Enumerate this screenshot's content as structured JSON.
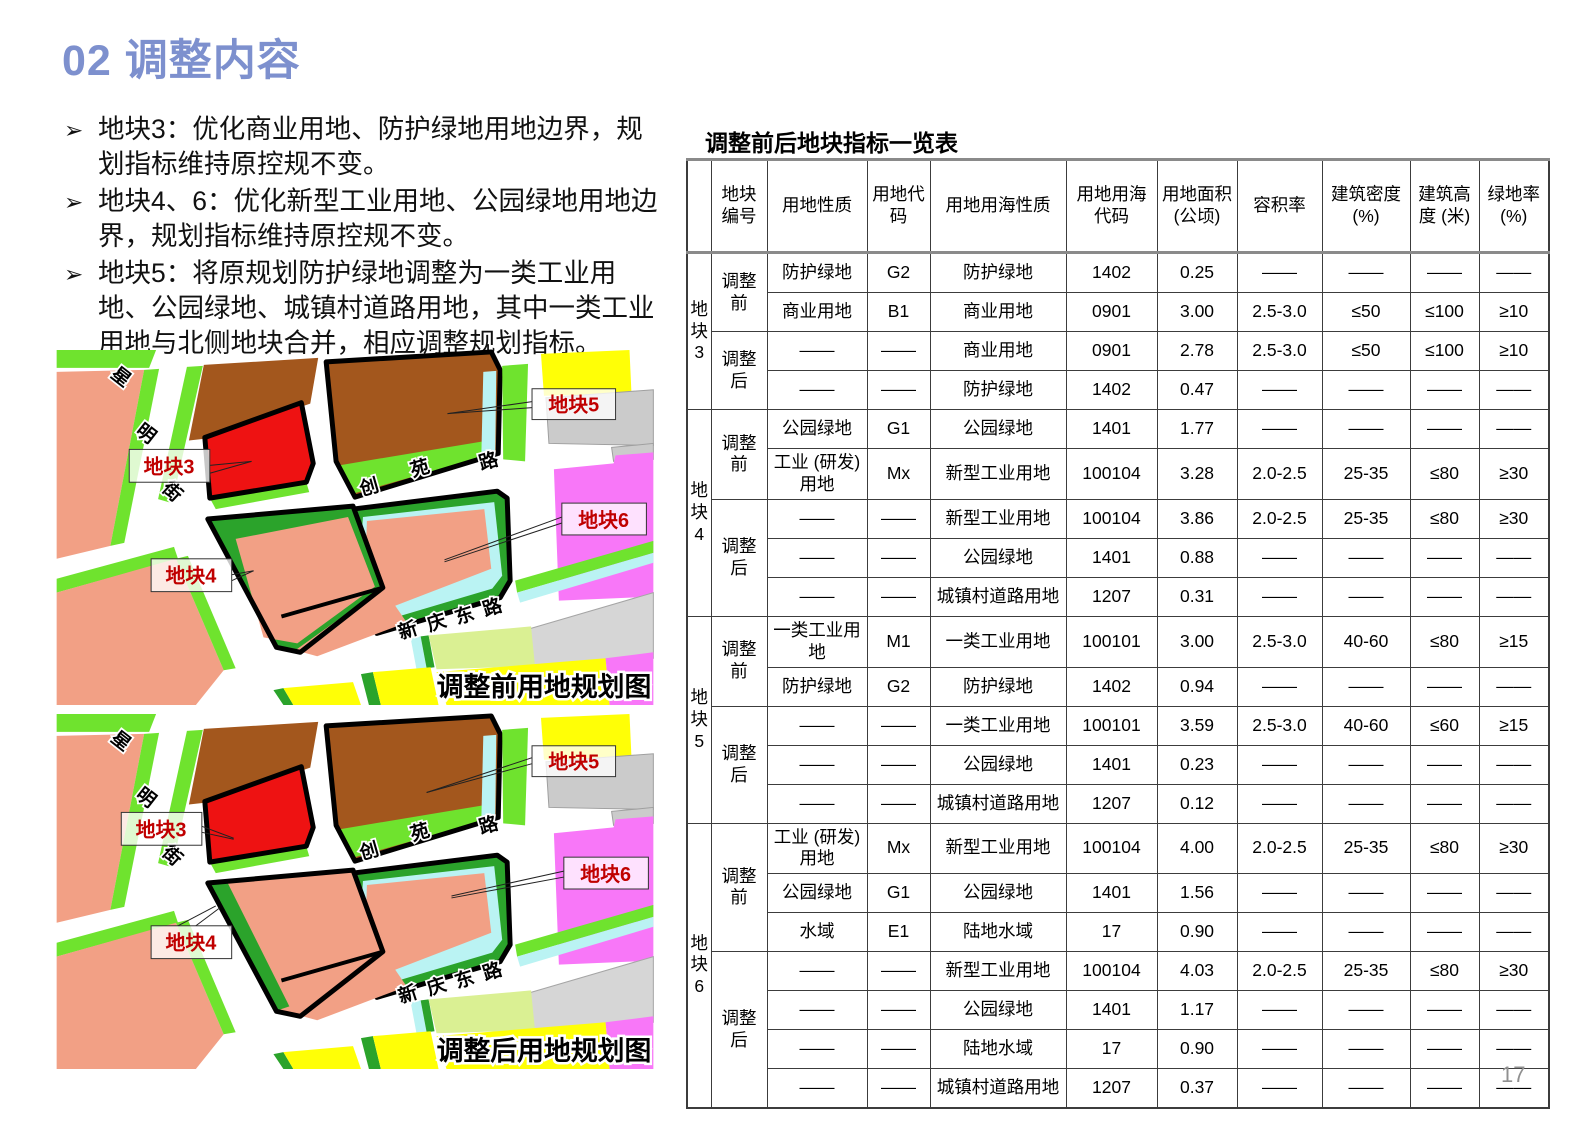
{
  "page": {
    "title": "02 调整内容",
    "page_number": "17"
  },
  "bullets": [
    "地块3：优化商业用地、防护绿地用地边界，规划指标维持原控规不变。",
    "地块4、6：优化新型工业用地、公园绿地用地边界，规划指标维持原控规不变。",
    "地块5：将原规划防护绿地调整为一类工业用地、公园绿地、城镇村道路用地，其中一类工业用地与北侧地块合并，相应调整规划指标。"
  ],
  "maps": {
    "before": {
      "caption": "调整前用地规划图"
    },
    "after": {
      "caption": "调整后用地规划图"
    },
    "streets": {
      "xingming": [
        "星",
        "明",
        "街"
      ],
      "chuangyuan": [
        "创",
        "苑",
        "路"
      ],
      "xinqingdong": [
        "新",
        "庆",
        "东",
        "路"
      ]
    },
    "plot_labels": {
      "p3": "地块3",
      "p4": "地块4",
      "p5": "地块5",
      "p6": "地块6"
    },
    "palette": {
      "title_blue": "#7d90ce",
      "label_red": "#c00000",
      "residential_salmon": "#f2a085",
      "industrial_brown": "#a3571d",
      "commercial_red": "#ee1212",
      "park_bright_green": "#6fe32e",
      "protective_dark_green": "#2ba32b",
      "water_cyan": "#baf3f3",
      "village_yellow": "#ffff06",
      "special_magenta": "#f877f8",
      "facility_gray": "#cbcbcb",
      "pale_green": "#daf093"
    }
  },
  "table": {
    "title": "调整前后地块指标一览表",
    "headers": [
      "地块编号",
      "用地性质",
      "用地代码",
      "用地用海性质",
      "用地用海代码",
      "用地面积 (公顷)",
      "容积率",
      "建筑密度 (%)",
      "建筑高度 (米)",
      "绿地率 (%)"
    ],
    "blocks": [
      {
        "label": "地块3",
        "phases": [
          {
            "label": "调整前",
            "rows": [
              [
                "防护绿地",
                "G2",
                "防护绿地",
                "1402",
                "0.25",
                "——",
                "——",
                "——",
                "——"
              ],
              [
                "商业用地",
                "B1",
                "商业用地",
                "0901",
                "3.00",
                "2.5-3.0",
                "≤50",
                "≤100",
                "≥10"
              ]
            ]
          },
          {
            "label": "调整后",
            "rows": [
              [
                "——",
                "——",
                "商业用地",
                "0901",
                "2.78",
                "2.5-3.0",
                "≤50",
                "≤100",
                "≥10"
              ],
              [
                "——",
                "——",
                "防护绿地",
                "1402",
                "0.47",
                "——",
                "——",
                "——",
                "——"
              ]
            ]
          }
        ]
      },
      {
        "label": "地块4",
        "phases": [
          {
            "label": "调整前",
            "rows": [
              [
                "公园绿地",
                "G1",
                "公园绿地",
                "1401",
                "1.77",
                "——",
                "——",
                "——",
                "——"
              ],
              [
                "工业 (研发) 用地",
                "Mx",
                "新型工业用地",
                "100104",
                "3.28",
                "2.0-2.5",
                "25-35",
                "≤80",
                "≥30"
              ]
            ]
          },
          {
            "label": "调整后",
            "rows": [
              [
                "——",
                "——",
                "新型工业用地",
                "100104",
                "3.86",
                "2.0-2.5",
                "25-35",
                "≤80",
                "≥30"
              ],
              [
                "——",
                "——",
                "公园绿地",
                "1401",
                "0.88",
                "——",
                "——",
                "——",
                "——"
              ],
              [
                "——",
                "——",
                "城镇村道路用地",
                "1207",
                "0.31",
                "——",
                "——",
                "——",
                "——"
              ]
            ]
          }
        ]
      },
      {
        "label": "地块5",
        "phases": [
          {
            "label": "调整前",
            "rows": [
              [
                "一类工业用地",
                "M1",
                "一类工业用地",
                "100101",
                "3.00",
                "2.5-3.0",
                "40-60",
                "≤80",
                "≥15"
              ],
              [
                "防护绿地",
                "G2",
                "防护绿地",
                "1402",
                "0.94",
                "——",
                "——",
                "——",
                "——"
              ]
            ]
          },
          {
            "label": "调整后",
            "rows": [
              [
                "——",
                "——",
                "一类工业用地",
                "100101",
                "3.59",
                "2.5-3.0",
                "40-60",
                "≤60",
                "≥15"
              ],
              [
                "——",
                "——",
                "公园绿地",
                "1401",
                "0.23",
                "——",
                "——",
                "——",
                "——"
              ],
              [
                "——",
                "——",
                "城镇村道路用地",
                "1207",
                "0.12",
                "——",
                "——",
                "——",
                "——"
              ]
            ]
          }
        ]
      },
      {
        "label": "地块6",
        "phases": [
          {
            "label": "调整前",
            "rows": [
              [
                "工业 (研发) 用地",
                "Mx",
                "新型工业用地",
                "100104",
                "4.00",
                "2.0-2.5",
                "25-35",
                "≤80",
                "≥30"
              ],
              [
                "公园绿地",
                "G1",
                "公园绿地",
                "1401",
                "1.56",
                "——",
                "——",
                "——",
                "——"
              ],
              [
                "水域",
                "E1",
                "陆地水域",
                "17",
                "0.90",
                "——",
                "——",
                "——",
                "——"
              ]
            ]
          },
          {
            "label": "调整后",
            "rows": [
              [
                "——",
                "——",
                "新型工业用地",
                "100104",
                "4.03",
                "2.0-2.5",
                "25-35",
                "≤80",
                "≥30"
              ],
              [
                "——",
                "——",
                "公园绿地",
                "1401",
                "1.17",
                "——",
                "——",
                "——",
                "——"
              ],
              [
                "——",
                "——",
                "陆地水域",
                "17",
                "0.90",
                "——",
                "——",
                "——",
                "——"
              ],
              [
                "——",
                "——",
                "城镇村道路用地",
                "1207",
                "0.37",
                "——",
                "——",
                "——",
                "——"
              ]
            ]
          }
        ]
      }
    ]
  }
}
